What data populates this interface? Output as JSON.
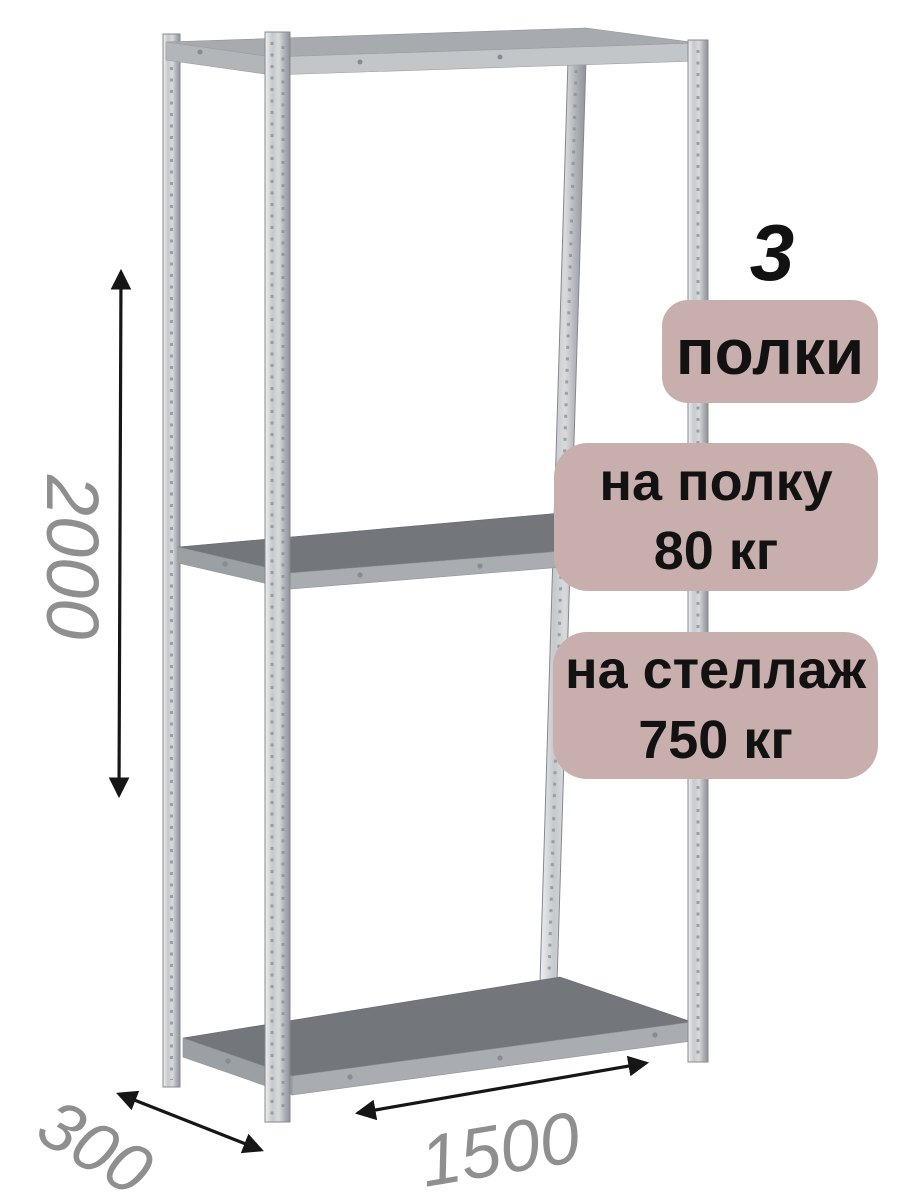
{
  "product": {
    "shelf_count": {
      "number": "3",
      "label": "полки"
    },
    "shelf_load": {
      "line1": "на полку",
      "line2": "80 кг"
    },
    "rack_load": {
      "line1": "на стеллаж",
      "line2": "750 кг"
    }
  },
  "dimensions": {
    "height_mm": "2000",
    "depth_mm": "300",
    "width_mm": "1500"
  },
  "colors": {
    "background": "#ffffff",
    "badge_bg": "#c9aeae",
    "badge_text": "#121212",
    "dimension_text": "#8f8f8f",
    "arrow": "#161616",
    "metal_light": "#cdd0d3",
    "metal_mid": "#a9adb1",
    "shelf_top": "#73777c"
  }
}
